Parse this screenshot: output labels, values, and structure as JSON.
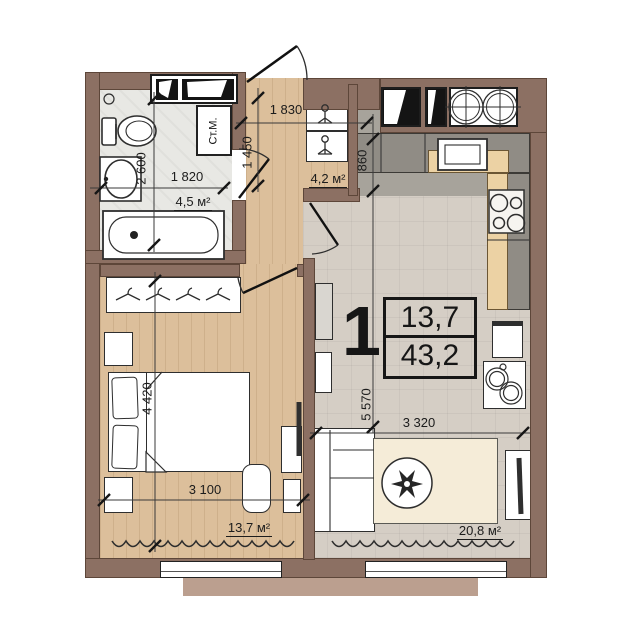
{
  "unit_info": {
    "rooms_count": "1",
    "living_area": "13,7",
    "total_area": "43,2"
  },
  "areas": {
    "bathroom": "4,5 м²",
    "hallway": "4,2 м²",
    "bedroom": "13,7 м²",
    "living_kitchen": "20,8 м²"
  },
  "dimensions": {
    "bathroom_width": "1 820",
    "bathroom_depth": "2 600",
    "hallway_width": "1 830",
    "hallway_depth": "1 450",
    "kitchen_counter_depth": "860",
    "living_length": "5 570",
    "living_width": "3 320",
    "bedroom_length": "4 420",
    "bedroom_width": "3 100"
  },
  "appliances": {
    "washing_machine": "Ст.М."
  },
  "colors": {
    "wall": "#8c7063",
    "wood_floor": "#dcbf9b",
    "tile_floor": "#d5cec5",
    "bath_floor": "#e8e8e4",
    "counter_gray": "#908c85",
    "counter_wood": "#ecd2a4",
    "rug": "#f5ecd8",
    "line": "#2b2b2b"
  }
}
